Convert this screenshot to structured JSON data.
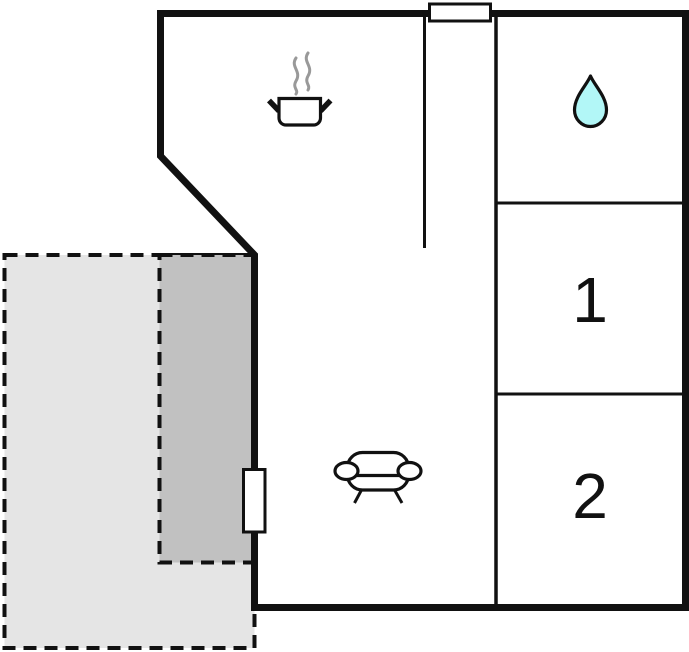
{
  "title": "Holiday home floor plan",
  "colors": {
    "wall": "#111111",
    "background": "#ffffff",
    "terrace_fill": "#e5e5e5",
    "covered_terrace_fill": "#c1c1c1",
    "water_drop_fill": "#b2f7f7",
    "steam": "#999999"
  },
  "rooms": [
    {
      "id": "kitchen",
      "label": "",
      "icon": "cooking-pot-icon"
    },
    {
      "id": "bathroom",
      "label": "",
      "icon": "water-drop-icon"
    },
    {
      "id": "bedroom-1",
      "label": "1",
      "icon": ""
    },
    {
      "id": "bedroom-2",
      "label": "2",
      "icon": ""
    },
    {
      "id": "living-area",
      "label": "",
      "icon": "sofa-icon"
    }
  ],
  "outdoor_areas": [
    {
      "id": "terrace",
      "style": "dashed-light-gray"
    },
    {
      "id": "covered-terrace",
      "style": "dashed-dark-gray"
    }
  ],
  "fixtures": [
    {
      "id": "entrance-door",
      "wall": "left"
    },
    {
      "id": "window-opening",
      "wall": "top"
    }
  ]
}
